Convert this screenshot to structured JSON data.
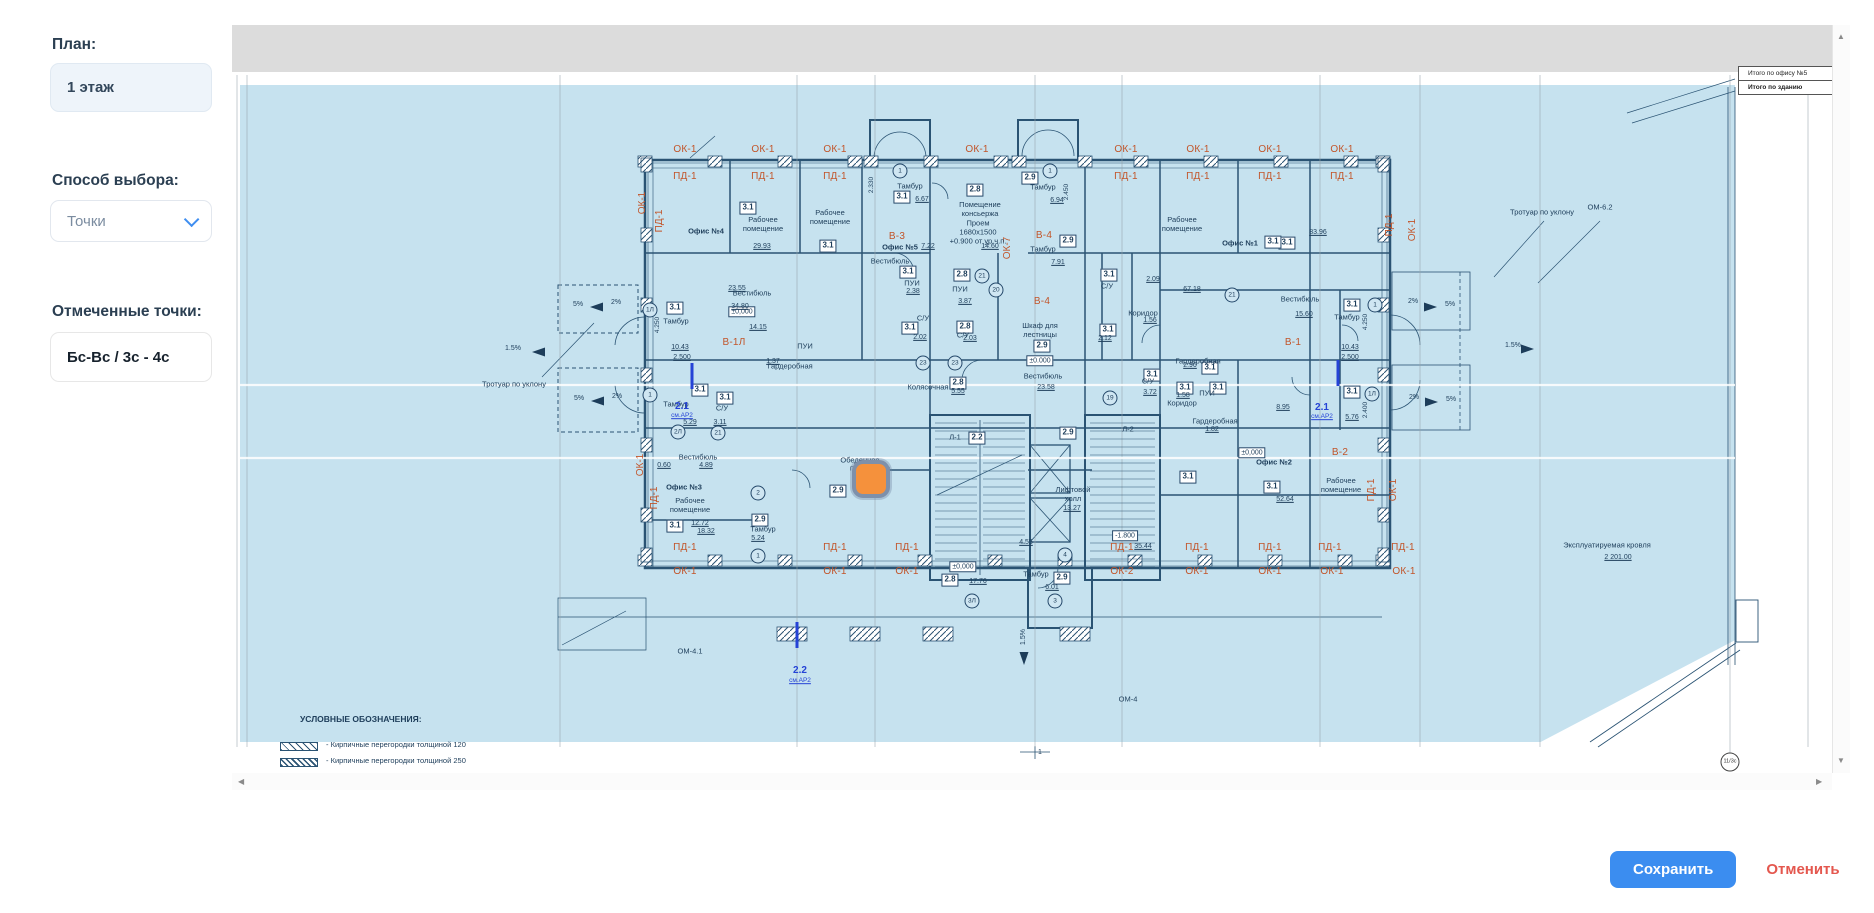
{
  "sidebar": {
    "plan_label": "План:",
    "plan_value": "1 этаж",
    "method_label": "Способ выбора:",
    "method_value": "Точки",
    "points_label": "Отмеченные точки:",
    "points_value": "Бс-Вс / 3с - 4с"
  },
  "actions": {
    "save": "Сохранить",
    "cancel": "Отменить"
  },
  "ui": {
    "scroll_up": "▲",
    "scroll_down": "▼",
    "scroll_left": "◀",
    "scroll_right": "▶"
  },
  "colors": {
    "accent": "#3b8df0",
    "cancel": "#e4574e",
    "plan_bg": "#c6e2ef",
    "wall": "#2a5373",
    "axis_label": "#c2552a",
    "marker": "#f5913c",
    "blue_note": "#2543d6"
  },
  "plan": {
    "summary_rows": [
      "Итого по офису №5",
      "Итого по зданию"
    ],
    "legend": {
      "title": "УСЛОВНЫЕ ОБОЗНАЧЕНИЯ:",
      "items": [
        "- Кирпичные перегородки толщиной 120",
        "- Кирпичные перегородки толщиной 250"
      ]
    },
    "marker": {
      "x": 620,
      "y": 435
    },
    "ticks": [
      [
        460,
        351
      ],
      [
        1106,
        348
      ],
      [
        565,
        610
      ]
    ],
    "labels": {
      "a": [
        [
          "ОК-1",
          453,
          125
        ],
        [
          "ОК-1",
          531,
          125
        ],
        [
          "ОК-1",
          603,
          125
        ],
        [
          "ОК-1",
          745,
          125
        ],
        [
          "ОК-1",
          894,
          125
        ],
        [
          "ОК-1",
          966,
          125
        ],
        [
          "ОК-1",
          1038,
          125
        ],
        [
          "ОК-1",
          1110,
          125
        ],
        [
          "ПД-1",
          453,
          152
        ],
        [
          "ПД-1",
          531,
          152
        ],
        [
          "ПД-1",
          603,
          152
        ],
        [
          "ПД-1",
          894,
          152
        ],
        [
          "ПД-1",
          966,
          152
        ],
        [
          "ПД-1",
          1038,
          152
        ],
        [
          "ПД-1",
          1110,
          152
        ],
        [
          "ПД-1",
          453,
          523
        ],
        [
          "ПД-1",
          603,
          523
        ],
        [
          "ПД-1",
          675,
          523
        ],
        [
          "ПД-1",
          890,
          523
        ],
        [
          "ПД-1",
          965,
          523
        ],
        [
          "ПД-1",
          1038,
          523
        ],
        [
          "ПД-1",
          1098,
          523
        ],
        [
          "ПД-1",
          1171,
          523
        ],
        [
          "ОК-1",
          453,
          547
        ],
        [
          "ОК-1",
          603,
          547
        ],
        [
          "ОК-1",
          675,
          547
        ],
        [
          "ОК-1",
          965,
          547
        ],
        [
          "ОК-1",
          1038,
          547
        ],
        [
          "ОК-1",
          1100,
          547
        ],
        [
          "ОК-1",
          1172,
          547
        ],
        [
          "ОК-2",
          890,
          547
        ],
        [
          "В-3",
          665,
          212
        ],
        [
          "В-4",
          812,
          211
        ],
        [
          "В-4",
          810,
          277
        ],
        [
          "В-1Л",
          502,
          318
        ],
        [
          "В-1",
          1061,
          318
        ],
        [
          "В-2",
          1108,
          428
        ]
      ],
      "av": [
        [
          "ОК-1",
          411,
          178
        ],
        [
          "ПД-1",
          428,
          196
        ],
        [
          "ПД-1",
          423,
          473
        ],
        [
          "ОК-1",
          409,
          440
        ],
        [
          "ПД-1",
          1158,
          200
        ],
        [
          "ОК-1",
          1181,
          205
        ],
        [
          "ПД-1",
          1140,
          465
        ],
        [
          "ОК-1",
          1162,
          465
        ],
        [
          "ОК-7",
          776,
          223
        ]
      ],
      "n": [
        [
          "3.1",
          516,
          183
        ],
        [
          "3.1",
          596,
          221
        ],
        [
          "3.1",
          670,
          172
        ],
        [
          "3.1",
          877,
          250
        ],
        [
          "3.1",
          1055,
          218
        ],
        [
          "3.1",
          1120,
          280
        ],
        [
          "3.1",
          1120,
          367
        ],
        [
          "3.1",
          443,
          283
        ],
        [
          "3.1",
          468,
          365
        ],
        [
          "3.1",
          493,
          373
        ],
        [
          "3.1",
          443,
          501
        ],
        [
          "3.1",
          676,
          247
        ],
        [
          "3.1",
          678,
          303
        ],
        [
          "3.1",
          876,
          305
        ],
        [
          "3.1",
          920,
          350
        ],
        [
          "3.1",
          953,
          363
        ],
        [
          "3.1",
          986,
          363
        ],
        [
          "3.1",
          978,
          343
        ],
        [
          "3.1",
          1040,
          462
        ],
        [
          "3.1",
          956,
          452
        ],
        [
          "3.1",
          1041,
          217
        ],
        [
          "2.8",
          743,
          165
        ],
        [
          "2.8",
          730,
          250
        ],
        [
          "2.8",
          733,
          302
        ],
        [
          "2.8",
          726,
          358
        ],
        [
          "2.8",
          718,
          555
        ],
        [
          "2.9",
          798,
          153
        ],
        [
          "2.9",
          836,
          216
        ],
        [
          "2.9",
          528,
          495
        ],
        [
          "2.9",
          606,
          466
        ],
        [
          "2.9",
          810,
          321
        ],
        [
          "2.9",
          836,
          408
        ],
        [
          "2.9",
          830,
          553
        ],
        [
          "2.2",
          745,
          413
        ]
      ],
      "bx": [
        [
          "±0,000",
          510,
          287
        ],
        [
          "±0.000",
          808,
          336
        ],
        [
          "±0,000",
          731,
          542
        ],
        [
          "±0,000",
          1020,
          428
        ],
        [
          "-1.800",
          893,
          511
        ]
      ],
      "d": [
        [
          "29.93",
          530,
          222
        ],
        [
          "6.67",
          690,
          175
        ],
        [
          "7.22",
          696,
          222
        ],
        [
          "23.55",
          505,
          264
        ],
        [
          "34.80",
          508,
          282
        ],
        [
          "14.15",
          526,
          303
        ],
        [
          "1.37",
          541,
          337
        ],
        [
          "6.94",
          825,
          176
        ],
        [
          "7.91",
          826,
          238
        ],
        [
          "14.60",
          758,
          222
        ],
        [
          "2.09",
          921,
          255
        ],
        [
          "83.96",
          1086,
          208
        ],
        [
          "67.18",
          960,
          265
        ],
        [
          "15.60",
          1072,
          290
        ],
        [
          "10.43",
          1118,
          323
        ],
        [
          "2.500",
          1118,
          333
        ],
        [
          "10.43",
          448,
          323
        ],
        [
          "2.500",
          450,
          333
        ],
        [
          "5.76",
          1120,
          393
        ],
        [
          "8.95",
          1051,
          383
        ],
        [
          "5.29",
          458,
          398
        ],
        [
          "3.11",
          488,
          398
        ],
        [
          "0.60",
          432,
          441
        ],
        [
          "4.89",
          474,
          441
        ],
        [
          "12.72",
          468,
          499
        ],
        [
          "18.32",
          474,
          507
        ],
        [
          "5.24",
          526,
          514
        ],
        [
          "23.58",
          814,
          363
        ],
        [
          "5.55",
          726,
          367
        ],
        [
          "13.27",
          840,
          484
        ],
        [
          "4.55",
          794,
          518
        ],
        [
          "6.01",
          820,
          563
        ],
        [
          "17.76",
          746,
          557
        ],
        [
          "35.44",
          911,
          522
        ],
        [
          "52.64",
          1053,
          475
        ],
        [
          "1.58",
          951,
          371
        ],
        [
          "1.56",
          918,
          296
        ],
        [
          "2.96",
          958,
          341
        ],
        [
          "1.82",
          980,
          405
        ],
        [
          "3.72",
          918,
          368
        ],
        [
          "2.38",
          681,
          267
        ],
        [
          "3.87",
          733,
          277
        ],
        [
          "2.03",
          738,
          314
        ],
        [
          "2.02",
          688,
          313
        ],
        [
          "2.12",
          873,
          314
        ],
        [
          "2 201.00",
          1386,
          533
        ]
      ],
      "dv": [
        [
          "2.330",
          640,
          160
        ],
        [
          "2.450",
          835,
          167
        ],
        [
          "4.250",
          426,
          300
        ],
        [
          "4.250",
          1134,
          297
        ],
        [
          "2.400",
          1134,
          385
        ]
      ],
      "rb": [
        [
          "Офис №4",
          474,
          207
        ],
        [
          "Офис №5",
          668,
          223
        ],
        [
          "Офис №1",
          1008,
          219
        ],
        [
          "Офис №3",
          452,
          463
        ],
        [
          "Офис №2",
          1042,
          438
        ]
      ],
      "r": [
        [
          "Рабочее\nпомещение",
          531,
          200
        ],
        [
          "Рабочее\nпомещение",
          598,
          193
        ],
        [
          "Тамбур",
          678,
          162
        ],
        [
          "Вестибюль",
          658,
          237
        ],
        [
          "Помещение\nконсьержа",
          748,
          185
        ],
        [
          "Проем\n1680х1500\n+0.900 от ур.ч.п.",
          746,
          208
        ],
        [
          "Тамбур",
          811,
          163
        ],
        [
          "Тамбур",
          811,
          225
        ],
        [
          "Рабочее\nпомещение",
          950,
          200
        ],
        [
          "Вестибюль",
          1068,
          275
        ],
        [
          "Тамбур",
          1115,
          293
        ],
        [
          "Тамбур",
          444,
          297
        ],
        [
          "Вестибюль",
          520,
          269
        ],
        [
          "Гардеробная",
          558,
          342
        ],
        [
          "ПУИ",
          573,
          322
        ],
        [
          "Тамбур",
          444,
          380
        ],
        [
          "С/У",
          490,
          384
        ],
        [
          "Вестибюль",
          466,
          433
        ],
        [
          "Рабочее\nпомещение",
          458,
          481
        ],
        [
          "Тамбур",
          531,
          505
        ],
        [
          "Шкаф для\nлестницы",
          808,
          306
        ],
        [
          "Вестибюль",
          811,
          352
        ],
        [
          "Колясочная",
          696,
          363
        ],
        [
          "Лифтовой\nхолл",
          841,
          470
        ],
        [
          "Тамбур",
          804,
          550
        ],
        [
          "Коридор",
          950,
          379
        ],
        [
          "Коридор",
          911,
          289
        ],
        [
          "Гардеробная",
          966,
          337
        ],
        [
          "Гардеробная",
          983,
          397
        ],
        [
          "ПУИ",
          975,
          369
        ],
        [
          "ПУИ",
          680,
          259
        ],
        [
          "ПУИ",
          728,
          265
        ],
        [
          "С/У",
          875,
          262
        ],
        [
          "С/У",
          731,
          311
        ],
        [
          "С/У",
          691,
          294
        ],
        [
          "С/У",
          916,
          357
        ],
        [
          "Рабочее\nпомещение",
          1109,
          461
        ],
        [
          "Эксплуатируемая кровля",
          1375,
          521
        ],
        [
          "Тротуар по уклону",
          1310,
          188
        ],
        [
          "Тротуар по уклону",
          282,
          360
        ],
        [
          "ОМ-6.2",
          1368,
          183
        ],
        [
          "ОМ-4.1",
          458,
          627
        ],
        [
          "ОМ-4",
          896,
          675
        ],
        [
          "Обеденное",
          628,
          436
        ],
        [
          "помещение",
          638,
          444
        ],
        [
          "Л-1",
          723,
          413
        ],
        [
          "Л-2",
          896,
          405
        ]
      ],
      "b": [
        [
          "2.1",
          450,
          382
        ],
        [
          "2.1",
          1090,
          383
        ],
        [
          "2.2",
          568,
          646
        ]
      ],
      "bs": [
        [
          "см.АР2",
          450,
          391
        ],
        [
          "см.АР2",
          1090,
          392
        ],
        [
          "см.АР2",
          568,
          656
        ]
      ],
      "c": [
        [
          "1Л",
          418,
          285
        ],
        [
          "1",
          418,
          370
        ],
        [
          "2Л",
          446,
          407
        ],
        [
          "21",
          486,
          408
        ],
        [
          "2",
          526,
          468
        ],
        [
          "1",
          526,
          531
        ],
        [
          "21",
          750,
          251
        ],
        [
          "20",
          764,
          265
        ],
        [
          "1",
          668,
          146
        ],
        [
          "1",
          818,
          146
        ],
        [
          "1",
          1143,
          280
        ],
        [
          "1Л",
          1140,
          369
        ],
        [
          "4",
          833,
          530
        ],
        [
          "3",
          823,
          576
        ],
        [
          "3Л",
          740,
          576
        ],
        [
          "19",
          878,
          373
        ],
        [
          "23",
          691,
          338
        ],
        [
          "23",
          723,
          338
        ],
        [
          "21",
          1000,
          270
        ]
      ],
      "cb": [
        [
          "11/3с",
          1498,
          737
        ]
      ],
      "t": [
        [
          "2%",
          384,
          278
        ],
        [
          "5%",
          346,
          280
        ],
        [
          "2%",
          385,
          372
        ],
        [
          "5%",
          347,
          374
        ],
        [
          "2%",
          1181,
          277
        ],
        [
          "5%",
          1218,
          280
        ],
        [
          "2%",
          1182,
          373
        ],
        [
          "5%",
          1219,
          375
        ],
        [
          "1.5%",
          281,
          324
        ],
        [
          "1.5%",
          1281,
          321
        ],
        [
          "1",
          808,
          728
        ]
      ],
      "tv": [
        [
          "1.5%",
          792,
          612
        ]
      ]
    }
  }
}
